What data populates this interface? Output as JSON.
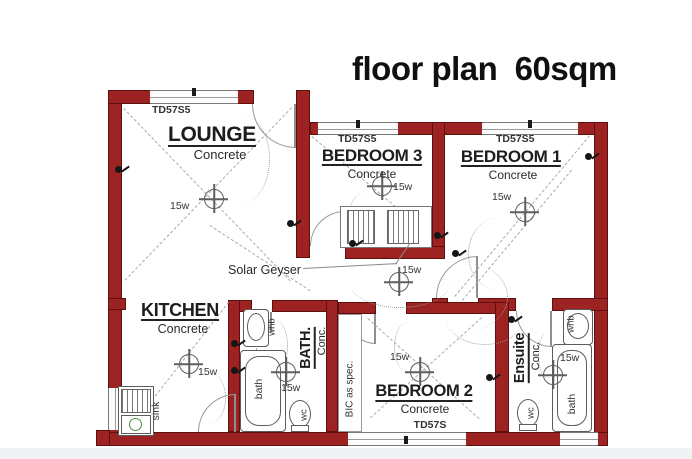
{
  "title": "floor plan  60sqm",
  "colors": {
    "wall": "#9c2321",
    "wall_edge": "#5e100e",
    "drawing_line": "#555555",
    "plumbing_green": "#6fae6f"
  },
  "rooms": {
    "lounge": {
      "name": "LOUNGE",
      "floor": "Concrete",
      "window_label": "TD57S5",
      "light": "15w"
    },
    "bedroom3": {
      "name": "BEDROOM 3",
      "floor": "Concrete",
      "window_label": "TD57S5",
      "light": "15w"
    },
    "bedroom1": {
      "name": "BEDROOM 1",
      "floor": "Concrete",
      "window_label": "TD57S5",
      "light": "15w"
    },
    "kitchen": {
      "name": "KITCHEN",
      "floor": "Concrete",
      "light": "15w",
      "sink_label": "sink"
    },
    "bath": {
      "name": "BATH.",
      "floor": "Conc.",
      "light": "15w",
      "whb_label": "whb",
      "bath_label": "bath",
      "wc_label": "wc"
    },
    "bedroom2": {
      "name": "BEDROOM 2",
      "floor": "Concrete",
      "window_label": "TD57S",
      "light": "15w",
      "bic_label": "BIC as spec."
    },
    "ensuite": {
      "name": "Ensuite",
      "floor": "Conc.",
      "light": "15w",
      "whb_label": "whb",
      "bath_label": "bath",
      "wc_label": "wc"
    },
    "hall": {
      "solar_geyser_label": "Solar Geyser",
      "light": "15w"
    }
  }
}
